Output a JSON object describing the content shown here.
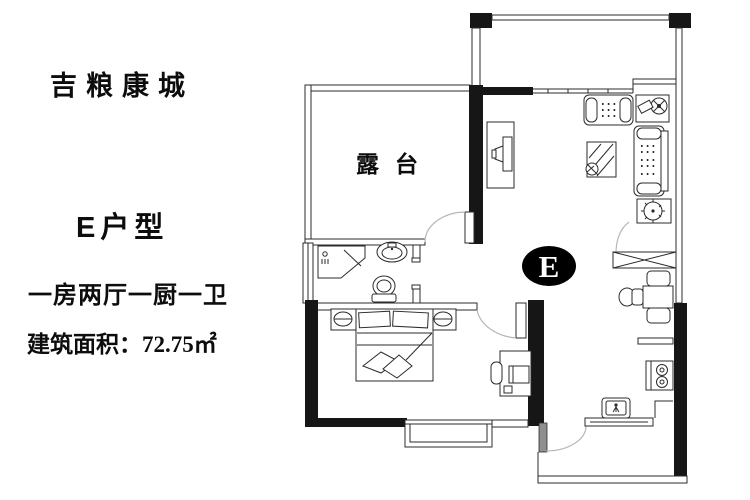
{
  "info_panel": {
    "project_name": "吉粮康城",
    "unit_type": "E户型",
    "layout_description": "一房两厅一厨一卫",
    "area_text": "建筑面积：72.75㎡"
  },
  "floor_plan": {
    "terrace_label": "露台",
    "unit_badge": "E"
  },
  "colors": {
    "wall": "#161616",
    "line": "#2b2b2b",
    "door_arc": "#b7b7b7",
    "badge_fill": "#000000",
    "background": "#ffffff"
  }
}
